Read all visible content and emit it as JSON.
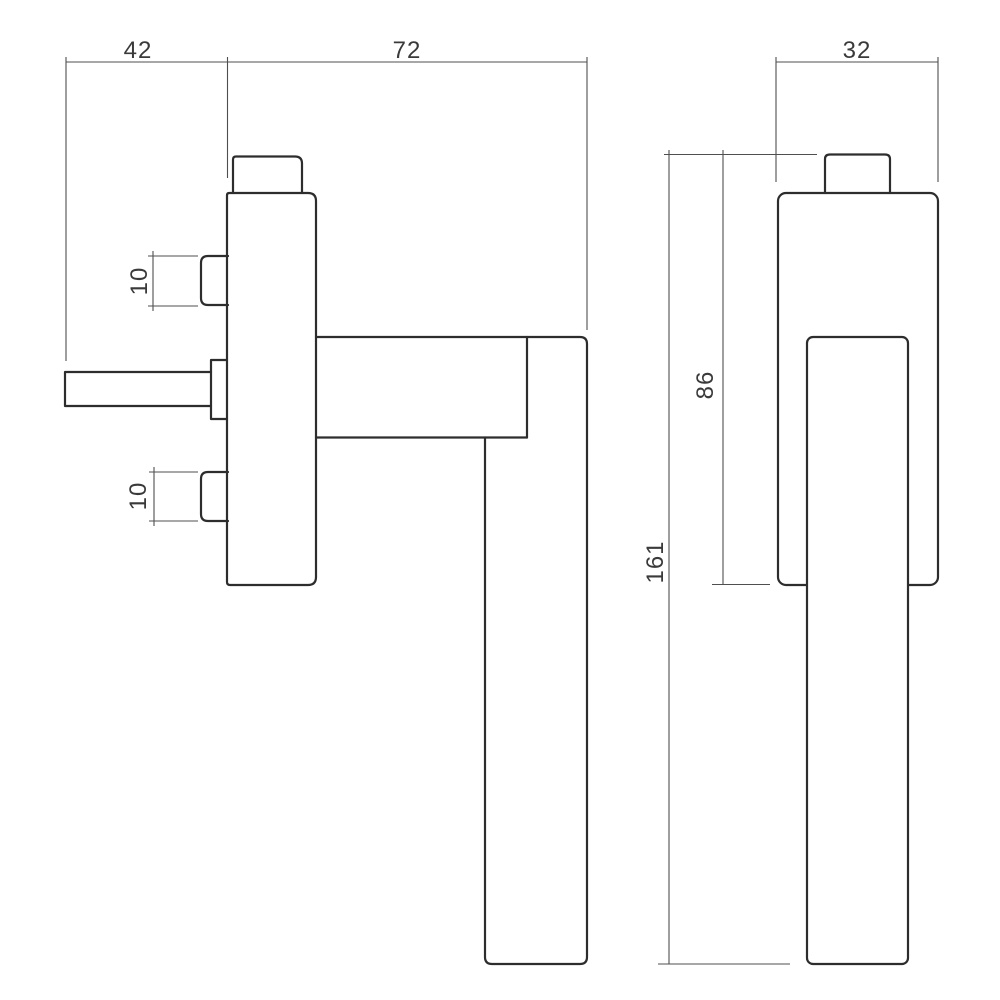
{
  "page": {
    "background": "#ffffff"
  },
  "colors": {
    "outline": "#2d2d2d",
    "dimension_lines": "#4f4f4f",
    "dimension_text": "#3a3a3a"
  },
  "dims": {
    "d42": "42",
    "d72": "72",
    "d32": "32",
    "d10_upper": "10",
    "d10_lower": "10",
    "d86": "86",
    "d161": "161"
  }
}
